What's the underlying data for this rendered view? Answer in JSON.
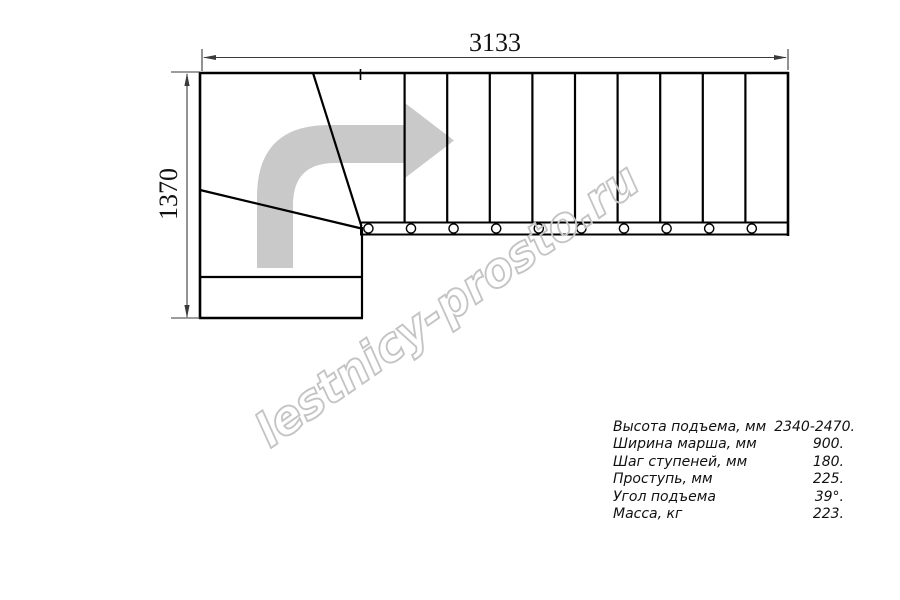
{
  "drawing": {
    "type": "l-shaped-staircase-top-view",
    "dimensions": {
      "width_mm": "3133",
      "height_mm": "1370"
    },
    "direction_arrow_icon": "curved-arrow-turn-right",
    "straight_flight": {
      "treads": 10,
      "balusters": 10
    },
    "winder_treads": 3,
    "entry_platform": true,
    "colors": {
      "background": "#ffffff",
      "line": "#000000",
      "dimension": "#3a3a3a",
      "arrow_fill": "#c9c9c9",
      "watermark_stroke": "#c4c4c4",
      "text": "#111111"
    }
  },
  "watermark": {
    "text": "lestnicy-prosto.ru"
  },
  "specs": {
    "rows": [
      {
        "label": "Высота подъема, мм",
        "value": "2340-2470."
      },
      {
        "label": "Ширина марша, мм",
        "value": "900."
      },
      {
        "label": "Шаг ступеней, мм",
        "value": "180."
      },
      {
        "label": "Проступь, мм",
        "value": "225."
      },
      {
        "label": "Угол подъема",
        "value": "39°."
      },
      {
        "label": "Масса, кг",
        "value": "223."
      }
    ]
  }
}
